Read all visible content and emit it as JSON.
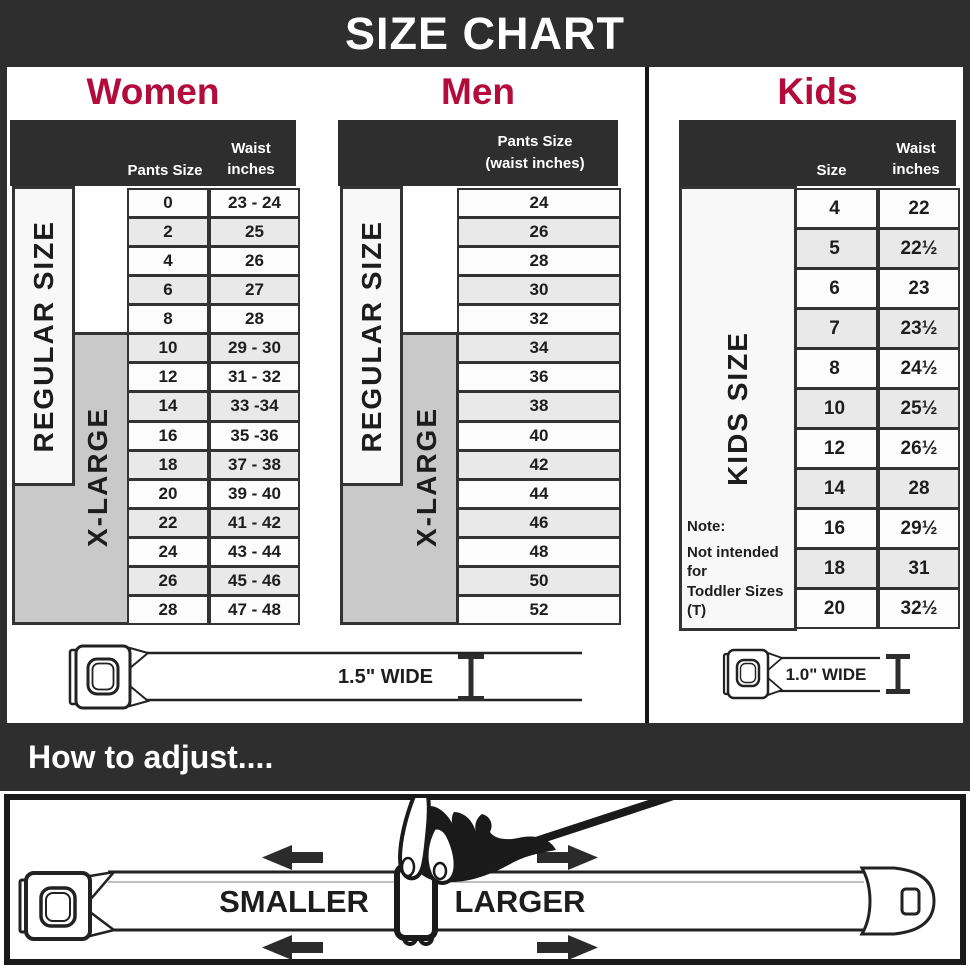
{
  "banner": {
    "title": "SIZE CHART"
  },
  "colors": {
    "accent": "#b30c3c",
    "header_bar": "#2e2e2e",
    "xlarge_grey": "#c9c9c9",
    "row_alt": "#e9e9e9"
  },
  "women": {
    "title": "Women",
    "header_col_size": "Pants Size",
    "header_col_waist_line1": "Waist",
    "header_col_waist_line2": "inches",
    "regular_label": "REGULAR SIZE",
    "xlarge_label": "X-LARGE",
    "rows": [
      [
        "0",
        "23 - 24"
      ],
      [
        "2",
        "25"
      ],
      [
        "4",
        "26"
      ],
      [
        "6",
        "27"
      ],
      [
        "8",
        "28"
      ],
      [
        "10",
        "29 - 30"
      ],
      [
        "12",
        "31 - 32"
      ],
      [
        "14",
        "33 -34"
      ],
      [
        "16",
        "35 -36"
      ],
      [
        "18",
        "37 - 38"
      ],
      [
        "20",
        "39 - 40"
      ],
      [
        "22",
        "41 - 42"
      ],
      [
        "24",
        "43 - 44"
      ],
      [
        "26",
        "45 - 46"
      ],
      [
        "28",
        "47 - 48"
      ]
    ],
    "belt_width_label": "1.5\" WIDE"
  },
  "men": {
    "title": "Men",
    "header_line1": "Pants Size",
    "header_line2": "(waist inches)",
    "regular_label": "REGULAR SIZE",
    "xlarge_label": "X-LARGE",
    "rows": [
      "24",
      "26",
      "28",
      "30",
      "32",
      "34",
      "36",
      "38",
      "40",
      "42",
      "44",
      "46",
      "48",
      "50",
      "52"
    ]
  },
  "kids": {
    "title": "Kids",
    "header_col_size": "Size",
    "header_col_waist_line1": "Waist",
    "header_col_waist_line2": "inches",
    "label": "KIDS SIZE",
    "note_title": "Note:",
    "note_line1": "Not intended for",
    "note_line2": "Toddler Sizes (T)",
    "rows": [
      [
        "4",
        "22"
      ],
      [
        "5",
        "22½"
      ],
      [
        "6",
        "23"
      ],
      [
        "7",
        "23½"
      ],
      [
        "8",
        "24½"
      ],
      [
        "10",
        "25½"
      ],
      [
        "12",
        "26½"
      ],
      [
        "14",
        "28"
      ],
      [
        "16",
        "29½"
      ],
      [
        "18",
        "31"
      ],
      [
        "20",
        "32½"
      ]
    ],
    "belt_width_label": "1.0\" WIDE"
  },
  "how_to": {
    "title": "How to adjust....",
    "smaller_label": "SMALLER",
    "larger_label": "LARGER"
  }
}
